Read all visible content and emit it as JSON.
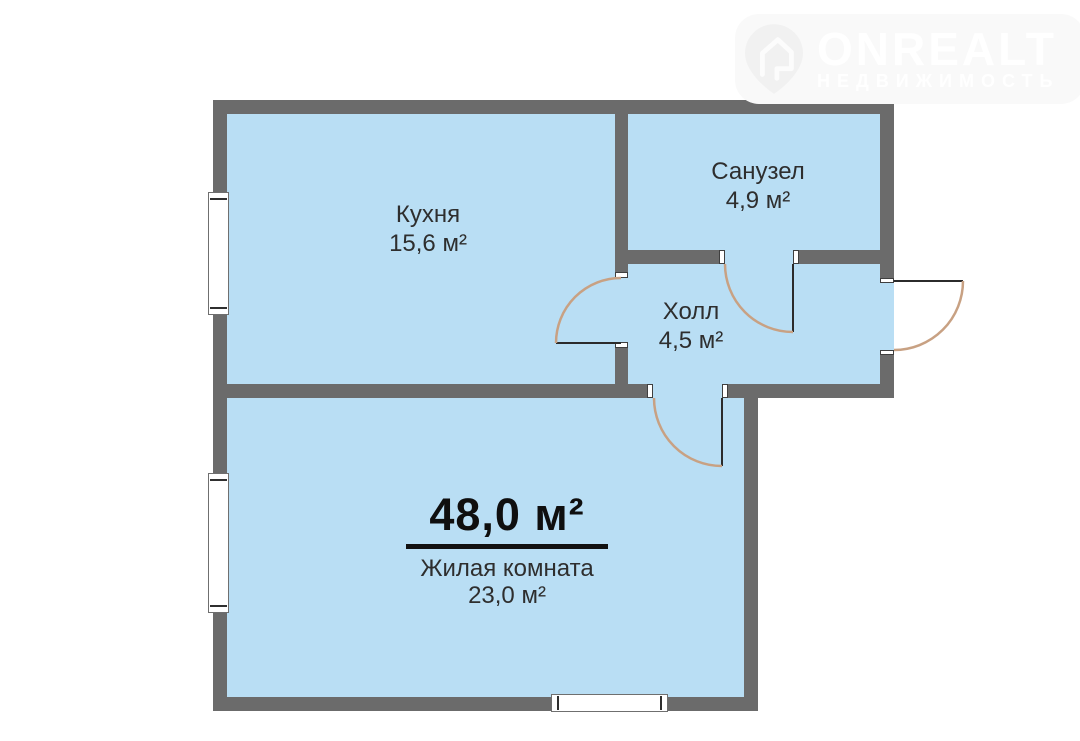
{
  "logo": {
    "brand": "ONREALT",
    "subtitle": "НЕДВИЖИМОСТЬ",
    "icon": "house-pin-icon"
  },
  "plan": {
    "total_area": "48,0 м²",
    "rooms": [
      {
        "name": "Кухня",
        "area": "15,6 м²"
      },
      {
        "name": "Санузел",
        "area": "4,9 м²"
      },
      {
        "name": "Холл",
        "area": "4,5 м²"
      },
      {
        "name": "Жилая комната",
        "area": "23,0 м²"
      }
    ]
  },
  "colors": {
    "room_fill": "#b9def4",
    "wall": "#6b6b6b",
    "door_arc": "#c8a183",
    "door_leaf": "#2b2b2b",
    "label_text": "#2e2e2e",
    "total_text": "#0f0f0f",
    "logo_watermark": "#ffffff"
  }
}
